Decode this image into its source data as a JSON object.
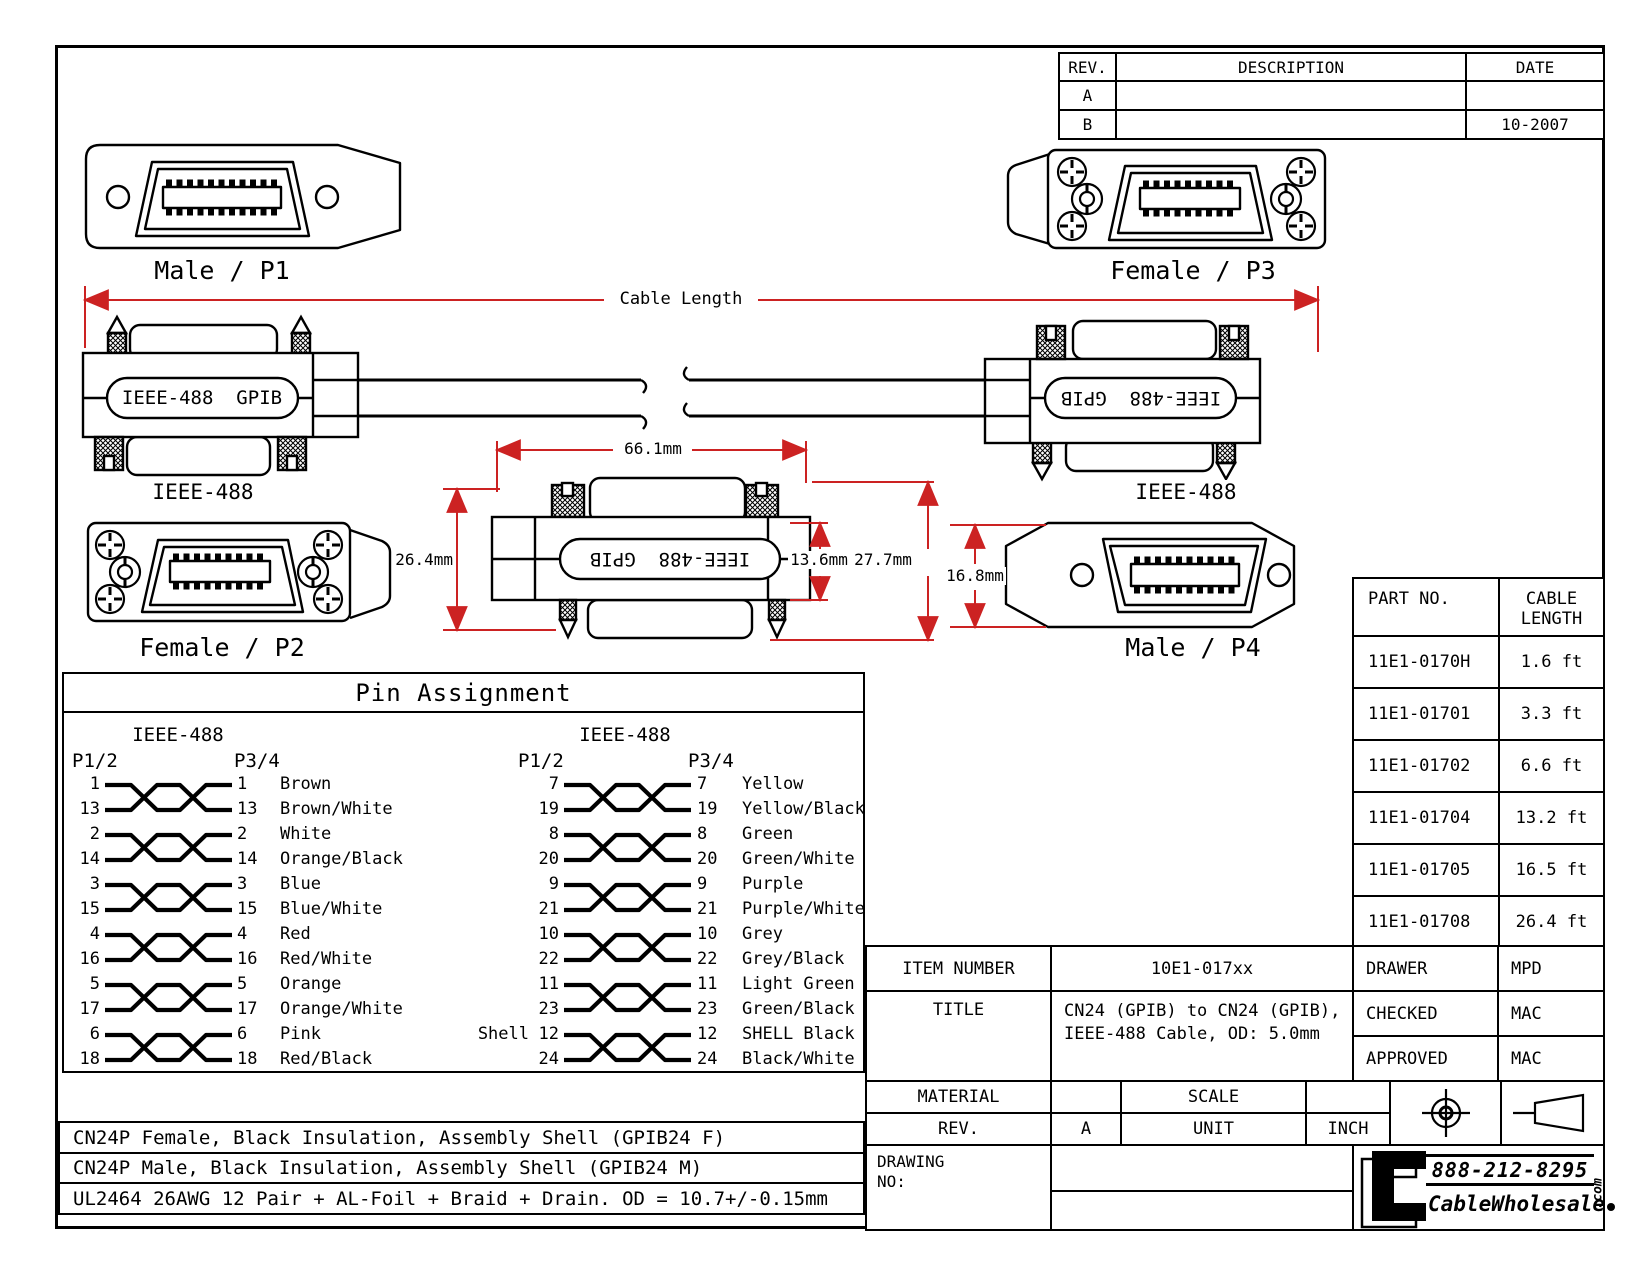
{
  "rev_table": {
    "header_rev": "REV.",
    "header_description": "DESCRIPTION",
    "header_date": "DATE",
    "rows": [
      {
        "rev": "A",
        "description": "",
        "date": ""
      },
      {
        "rev": "B",
        "description": "",
        "date": "10-2007"
      }
    ]
  },
  "connectors": {
    "p1_label": "Male / P1",
    "p2_label": "Female / P2",
    "p3_label": "Female / P3",
    "p4_label": "Male / P4",
    "left_cable_label": "IEEE-488",
    "right_cable_label": "IEEE-488",
    "shell_text": "IEEE-488  GPIB"
  },
  "dimensions": {
    "cable_length_label": "Cable Length",
    "connector_width": "66.1mm",
    "connector_height": "26.4mm",
    "face_height": "13.6mm",
    "total_height": "27.7mm",
    "p4_height": "16.8mm"
  },
  "pin_assignment": {
    "title": "Pin Assignment",
    "left": {
      "standard": "IEEE-488",
      "near": "P1/2",
      "far": "P3/4",
      "pairs": [
        {
          "prefix": "",
          "a1": "1",
          "a2": "13",
          "b1": "1",
          "c1": "Brown",
          "b2": "13",
          "c2": "Brown/White"
        },
        {
          "prefix": "",
          "a1": "2",
          "a2": "14",
          "b1": "2",
          "c1": "White",
          "b2": "14",
          "c2": "Orange/Black"
        },
        {
          "prefix": "",
          "a1": "3",
          "a2": "15",
          "b1": "3",
          "c1": "Blue",
          "b2": "15",
          "c2": "Blue/White"
        },
        {
          "prefix": "",
          "a1": "4",
          "a2": "16",
          "b1": "4",
          "c1": "Red",
          "b2": "16",
          "c2": "Red/White"
        },
        {
          "prefix": "",
          "a1": "5",
          "a2": "17",
          "b1": "5",
          "c1": "Orange",
          "b2": "17",
          "c2": "Orange/White"
        },
        {
          "prefix": "",
          "a1": "6",
          "a2": "18",
          "b1": "6",
          "c1": "Pink",
          "b2": "18",
          "c2": "Red/Black"
        }
      ]
    },
    "right": {
      "standard": "IEEE-488",
      "near": "P1/2",
      "far": "P3/4",
      "pairs": [
        {
          "prefix": "",
          "a1": "7",
          "a2": "19",
          "b1": "7",
          "c1": "Yellow",
          "b2": "19",
          "c2": "Yellow/Black"
        },
        {
          "prefix": "",
          "a1": "8",
          "a2": "20",
          "b1": "8",
          "c1": "Green",
          "b2": "20",
          "c2": "Green/White"
        },
        {
          "prefix": "",
          "a1": "9",
          "a2": "21",
          "b1": "9",
          "c1": "Purple",
          "b2": "21",
          "c2": "Purple/White"
        },
        {
          "prefix": "",
          "a1": "10",
          "a2": "22",
          "b1": "10",
          "c1": "Grey",
          "b2": "22",
          "c2": "Grey/Black"
        },
        {
          "prefix": "",
          "a1": "11",
          "a2": "23",
          "b1": "11",
          "c1": "Light Green",
          "b2": "23",
          "c2": "Green/Black"
        },
        {
          "prefix": "Shell",
          "a1": "12",
          "a2": "24",
          "b1": "12",
          "c1": "SHELL Black",
          "b2": "24",
          "c2": "Black/White"
        }
      ]
    }
  },
  "part_table": {
    "header_part": "PART NO.",
    "header_length": "CABLE LENGTH",
    "rows": [
      {
        "part": "11E1-0170H",
        "length": "1.6 ft"
      },
      {
        "part": "11E1-01701",
        "length": "3.3 ft"
      },
      {
        "part": "11E1-01702",
        "length": "6.6 ft"
      },
      {
        "part": "11E1-01704",
        "length": "13.2 ft"
      },
      {
        "part": "11E1-01705",
        "length": "16.5 ft"
      },
      {
        "part": "11E1-01708",
        "length": "26.4 ft"
      }
    ]
  },
  "title_block": {
    "item_number_label": "ITEM NUMBER",
    "item_number": "10E1-017xx",
    "title_label": "TITLE",
    "title_line1": "CN24 (GPIB) to CN24 (GPIB),",
    "title_line2": "IEEE-488 Cable, OD: 5.0mm",
    "drawer_label": "DRAWER",
    "drawer": "MPD",
    "checked_label": "CHECKED",
    "checked": "MAC",
    "approved_label": "APPROVED",
    "approved": "MAC",
    "material_label": "MATERIAL",
    "scale_label": "SCALE",
    "rev_label": "REV.",
    "rev": "A",
    "unit_label": "UNIT",
    "unit": "INCH",
    "drawing_no_label": "DRAWING NO:"
  },
  "notes": [
    "CN24P Female, Black Insulation, Assembly Shell (GPIB24 F)",
    "CN24P Male, Black Insulation, Assembly Shell (GPIB24 M)",
    "UL2464 26AWG 12 Pair + AL-Foil + Braid + Drain. OD = 10.7+/-0.15mm"
  ],
  "logo": {
    "phone": "888-212-8295",
    "name": "CableWholesale",
    "tld": ".com"
  },
  "colors": {
    "dim_red": "#cc2222",
    "line_black": "#000000"
  }
}
